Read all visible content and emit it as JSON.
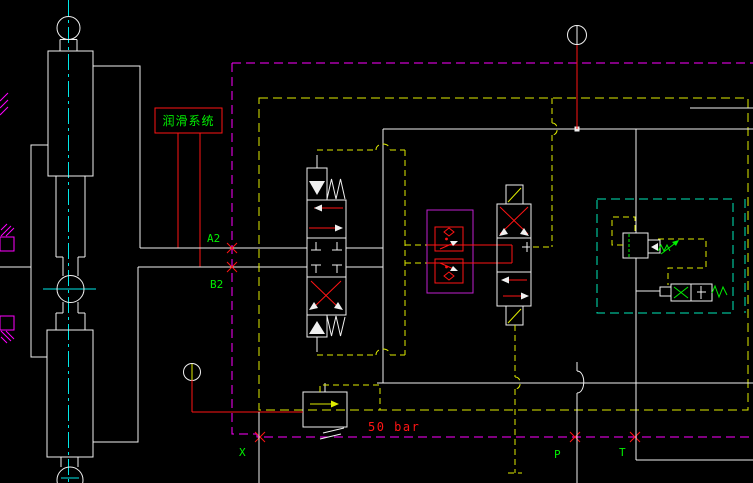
{
  "drawing": {
    "background": "#000000",
    "labels": {
      "lubrication_system": "润滑系统",
      "port_a2": "A2",
      "port_b2": "B2",
      "port_x": "X",
      "port_p": "P",
      "port_t": "T",
      "relief_setting": "50 bar"
    },
    "colors": {
      "background": "#000000",
      "white": "#f0f0f0",
      "red": "#ff1414",
      "green": "#00f000",
      "yellow": "#dfec00",
      "magenta": "#ff00ff",
      "purple": "#c020d0",
      "cyan": "#00e8e8",
      "teal": "#00e8b8"
    }
  }
}
